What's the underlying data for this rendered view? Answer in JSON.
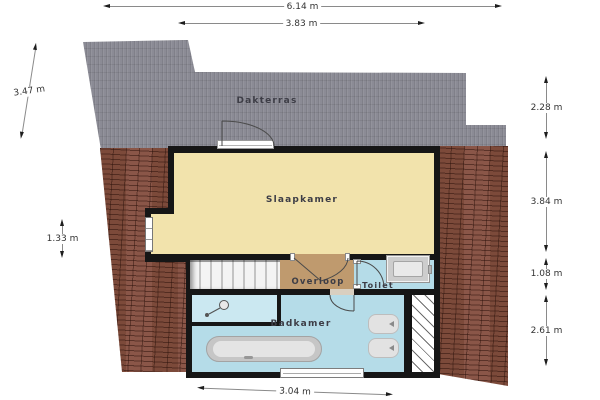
{
  "labels": {
    "dakterras": "Dakterras",
    "slaapkamer": "Slaapkamer",
    "overloop": "Overloop",
    "toilet": "Toilet",
    "badkamer": "Badkamer"
  },
  "dimensions": {
    "top_total": "6.14 m",
    "top_terrace": "3.83 m",
    "left_terrace": "3.47 m",
    "left_window": "1.33 m",
    "right_terrace": "2.28 m",
    "right_bedroom": "3.84 m",
    "right_landing": "1.08 m",
    "right_bathroom": "2.61 m",
    "bottom_bathroom": "3.04 m"
  },
  "fixtures": {
    "icons": [
      "staircase",
      "door-swing",
      "window",
      "bathtub",
      "washbasin",
      "washbasin",
      "toilet-cistern",
      "shower-head",
      "roof-tiles",
      "low-ceiling-hatch"
    ]
  },
  "colors": {
    "terrace": "#8b8b95",
    "roof": "#7c4a3a",
    "bedroom": "#f2e3ac",
    "landing": "#bf9a6e",
    "bathroom": "#b5dce8",
    "shower": "#cbe8f1",
    "wall": "#161616",
    "dimline": "#8a8a8a",
    "dimtext": "#333333",
    "labeltext": "#3d3d46"
  }
}
